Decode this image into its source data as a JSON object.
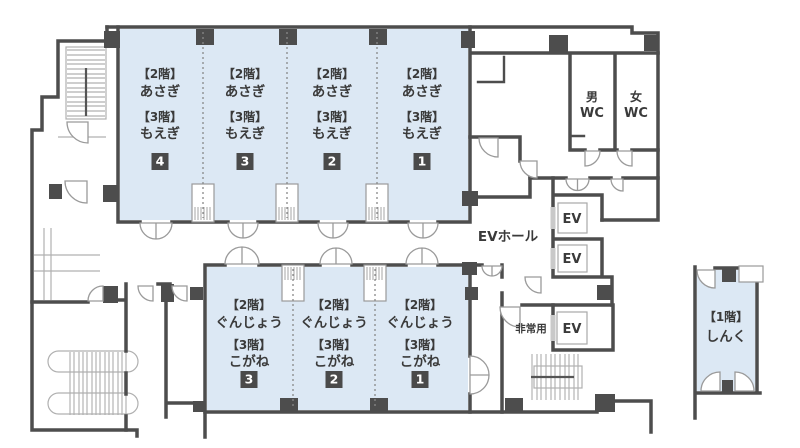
{
  "colors": {
    "room_fill": "#dce8f4",
    "wall": "#4d4d4d",
    "badge_bg": "#4a4a4a",
    "badge_text": "#ffffff"
  },
  "upper_block": {
    "floor2_prefix": "【2階】",
    "floor2_room": "あさぎ",
    "floor3_prefix": "【3階】",
    "floor3_room": "もえぎ",
    "sections": [
      {
        "number": "4"
      },
      {
        "number": "3"
      },
      {
        "number": "2"
      },
      {
        "number": "1"
      }
    ]
  },
  "lower_block": {
    "floor2_prefix": "【2階】",
    "floor2_room": "ぐんじょう",
    "floor3_prefix": "【3階】",
    "floor3_room": "こがね",
    "sections": [
      {
        "number": "3"
      },
      {
        "number": "2"
      },
      {
        "number": "1"
      }
    ]
  },
  "annex": {
    "floor_prefix": "【1階】",
    "room": "しんく"
  },
  "facilities": {
    "ev_hall": "EVホール",
    "elevator": "EV",
    "emergency": "非常用",
    "wc_men": "男",
    "wc_women": "女",
    "wc": "WC"
  }
}
